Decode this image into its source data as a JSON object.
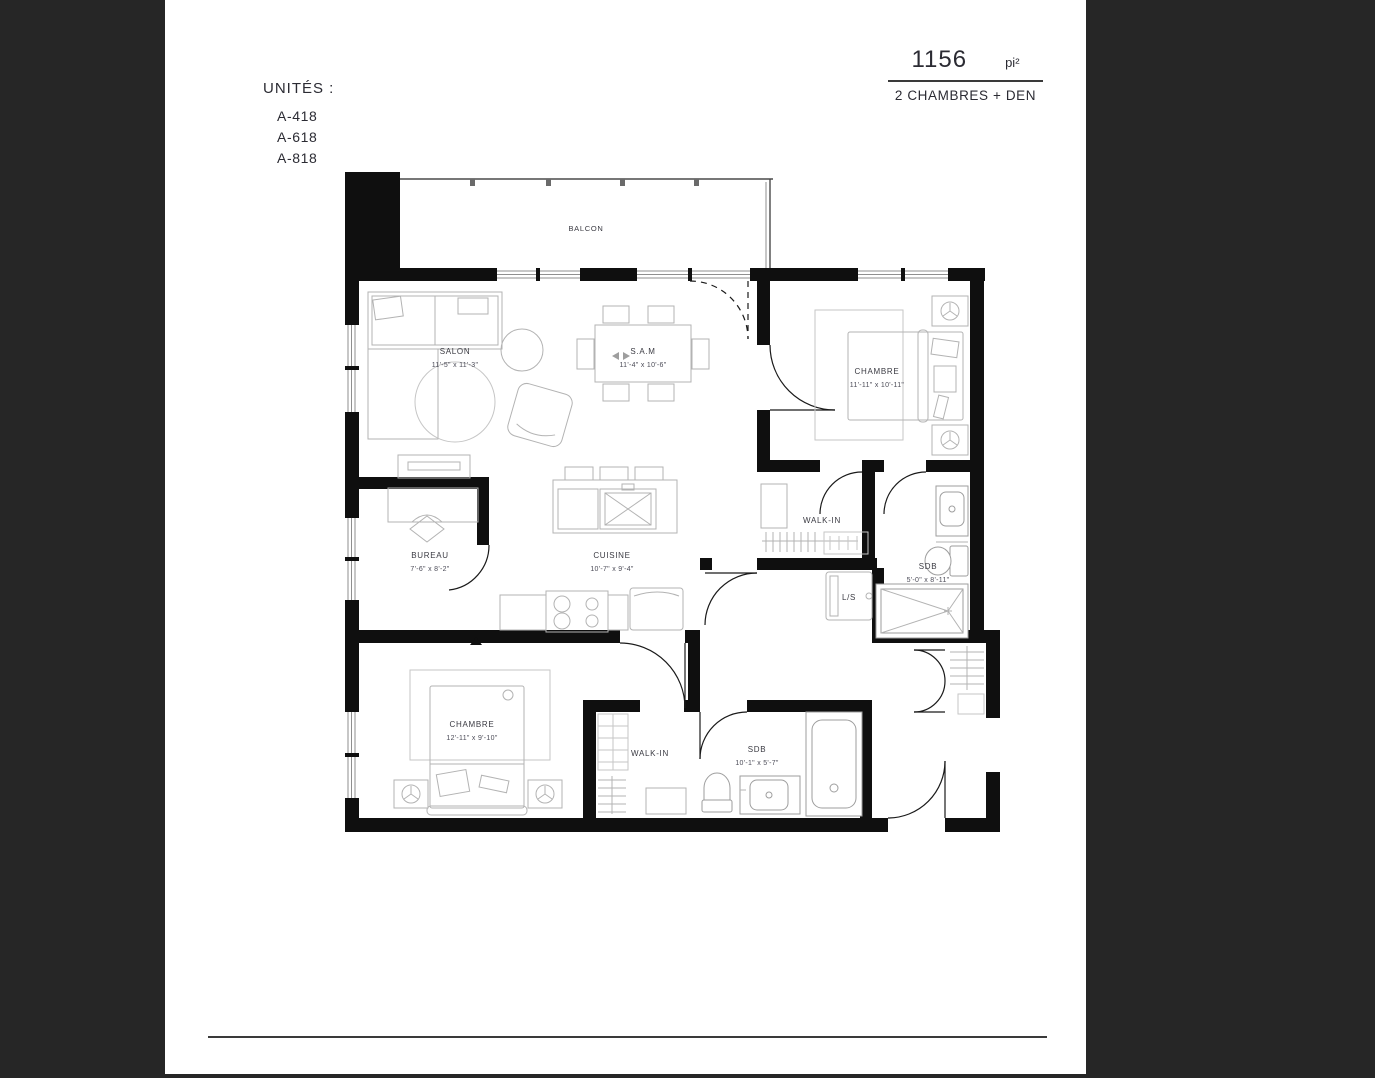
{
  "header": {
    "area_value": "1156",
    "area_unit": "pi²",
    "subtitle": "2 CHAMBRES + DEN"
  },
  "units": {
    "title": "UNITÉS :",
    "items": [
      "A-418",
      "A-618",
      "A-818"
    ]
  },
  "plan": {
    "balcony": {
      "name": "BALCON"
    },
    "rooms": [
      {
        "name": "SALON",
        "dims": "11'-5\" x 11'-3\""
      },
      {
        "name": "S.A.M",
        "dims": "11'-4\" x 10'-6\""
      },
      {
        "name": "CHAMBRE",
        "dims": "11'-11\" x 10'-11\""
      },
      {
        "name": "BUREAU",
        "dims": "7'-6\" x 8'-2\""
      },
      {
        "name": "CUISINE",
        "dims": "10'-7\" x 9'-4\""
      },
      {
        "name": "WALK-IN",
        "dims": ""
      },
      {
        "name": "SDB",
        "dims": "5'-0\" x 8'-11\""
      },
      {
        "name": "L/S",
        "dims": ""
      },
      {
        "name": "CHAMBRE",
        "dims": "12'-11\" x 9'-10\""
      },
      {
        "name": "WALK-IN",
        "dims": ""
      },
      {
        "name": "SDB",
        "dims": "10'-1\" x 5'-7\""
      }
    ]
  },
  "colors": {
    "frame": "#262626",
    "wall": "#0f0f0f",
    "text": "#2b2b33"
  }
}
